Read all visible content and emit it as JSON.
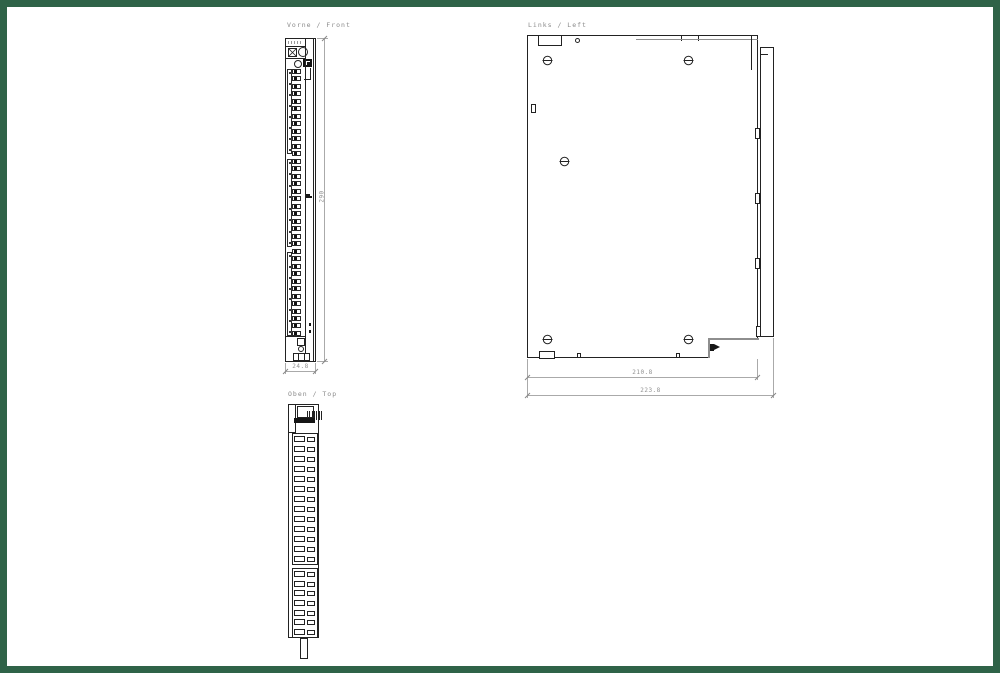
{
  "frame": {
    "color": "#2f6348"
  },
  "titles": {
    "front": "Vorne / Front",
    "left": "Links / Left",
    "top": "Oben / Top"
  },
  "dimensions": {
    "front_width": "24.8",
    "front_height": "290",
    "left_depth_inner": "210.8",
    "left_depth_outer": "223.8"
  },
  "counts": {
    "front_terminals": 36,
    "front_label_ticks": 8,
    "top_pins": 7,
    "top_rows_a": 13,
    "top_rows_b": 7
  }
}
